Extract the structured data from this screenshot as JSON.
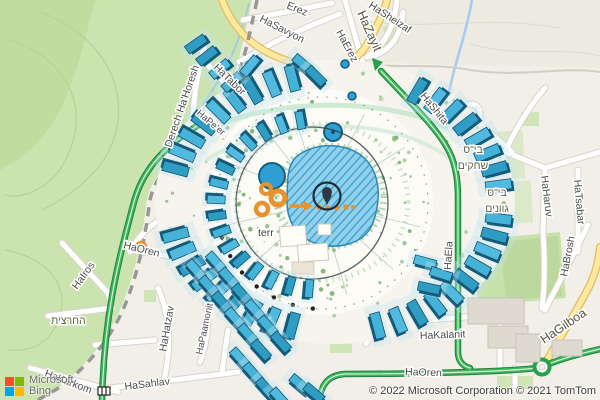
{
  "map": {
    "street_labels": {
      "erez": "Erez",
      "hasavyon": "HaSavyon",
      "hasheizaf": "HaSheizaf",
      "haerez": "HaErez",
      "hazayit": "HaZayit",
      "hashita": "HaShita",
      "derech_hahoresh": "Derech Ha'Horesh",
      "hatabor": "HaTabor",
      "hapeer": "HaPe'er",
      "haharuv": "HaHaruv",
      "hatsabar": "HaTsabar",
      "habrosh": "HaBrosh",
      "haela": "HaEla",
      "hagilboa": "HaGilboa",
      "hakalanit": "HaKalanit",
      "haoren_east": "HaOren",
      "haoren_west": "HaOren",
      "hairos": "HaIros",
      "hahartzit": "החרצית",
      "hahatzav": "HaHatzav",
      "hapaamonit": "HaPaamonit",
      "hasahlav": "HaSahlav",
      "hakarkom": "HaKarkom"
    },
    "place_labels": {
      "school_shahakim_line1": "בי\"ס",
      "school_shahakim_line2": "שחקים",
      "school_gvanim_line1": "בי\"ס",
      "school_gvanim_line2": "גוונים",
      "terrace": "terr"
    }
  },
  "attribution": {
    "brand_line1": "Microsoft",
    "brand_line2": "Bing",
    "copyright": "© 2022 Microsoft Corporation © 2021 TomTom"
  },
  "colors": {
    "park_green": "#cbe3ae",
    "route_green": "#34ac53",
    "road_yellow": "#ffe99e",
    "water_blue": "#a8cbf0",
    "building_teal": "#45b2d8",
    "poi_orange": "#e8922e",
    "boundary_gray": "#8e8e8e",
    "logo_red": "#f25022",
    "logo_green": "#7fba00",
    "logo_blue": "#00a4ef",
    "logo_yellow": "#ffb900"
  }
}
